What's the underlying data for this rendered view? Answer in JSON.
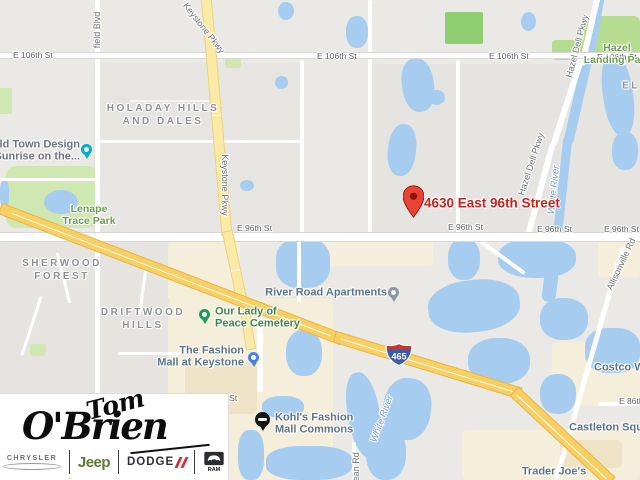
{
  "theme": {
    "land": "#eae9e6",
    "water": "#a6cdf0",
    "park": "#cfe7b0",
    "park_bright": "#8fce71",
    "park_dark": "#b5dc90",
    "cemetery": "#c9e2bd",
    "beige": "#f5eedb",
    "beige_dark": "#eee3c6",
    "road_casing": "#d9d8d4",
    "highway_fill": "#f7cf63",
    "highway_casing": "#e7b54a",
    "parkway_fill": "#fbe9a6",
    "parkway_casing": "#ecd184",
    "street_label": "#63656a",
    "road_label": "#717479",
    "neighborhood_label": "#8f9194",
    "water_label": "#7b9cc4",
    "park_label": "#6f9e50",
    "poi_blue": "#5d7689",
    "poi_green": "#44874a",
    "poi_gray": "#6d7480",
    "dest_red": "#c5251c",
    "pin_red": "#ea4335",
    "pin_red_dark": "#8a1508",
    "pin_teal": "#00b0c7",
    "pin_green": "#1a9e5c",
    "pin_blue": "#4583ec",
    "pin_gray": "#8a99a5",
    "pin_kohls": "#141414",
    "shield_blue": "#3d5ba9",
    "shield_red": "#be3a31"
  },
  "map": {
    "street_labels": [
      {
        "text": "E 106th St"
      },
      {
        "text": "E 106th St"
      },
      {
        "text": "E 106th St"
      },
      {
        "text": "E 106th St"
      },
      {
        "text": "E 96th St"
      },
      {
        "text": "E 96th St"
      },
      {
        "text": "E 96th St"
      },
      {
        "text": "E 96th St"
      },
      {
        "text": "E 86th St"
      },
      {
        "text": "h St"
      }
    ],
    "road_labels": [
      {
        "text": "field Blvd"
      },
      {
        "text": "Keystone Pkwy"
      },
      {
        "text": "Keystone Pkwy"
      },
      {
        "text": "Hazel Dell Pkwy"
      },
      {
        "text": "Hazel Dell Pkwy"
      },
      {
        "text": "Allisonville Rd"
      },
      {
        "text": "Dean Rd"
      }
    ],
    "water_labels": [
      {
        "text": "White River"
      },
      {
        "text": "White River"
      }
    ],
    "park_labels": [
      {
        "l1": "Hazel",
        "l2": "Landing Park"
      },
      {
        "l1": "Lenape",
        "l2": "Trace Park"
      }
    ],
    "neighborhoods": [
      {
        "l1": "HOLADAY HILLS",
        "l2": "AND DALES"
      },
      {
        "l1": "SHERWOOD",
        "l2": "FOREST"
      },
      {
        "l1": "DRIFTWOOD",
        "l2": "HILLS"
      },
      {
        "l1": "EL",
        "l2": ""
      }
    ],
    "pois": [
      {
        "l1": "Old Town Design",
        "l2": "(Sunrise on the..."
      },
      {
        "l1": "Our Lady of",
        "l2": "Peace Cemetery"
      },
      {
        "l1": "The Fashion",
        "l2": "Mall at Keystone"
      },
      {
        "l1": "River Road Apartments",
        "l2": ""
      },
      {
        "l1": "Kohl's Fashion",
        "l2": "Mall Commons"
      },
      {
        "l1": "Trader Joe's",
        "l2": ""
      },
      {
        "l1": "Castleton Square",
        "l2": ""
      },
      {
        "l1": "Costco Wholesale",
        "l2": ""
      }
    ],
    "destination": {
      "address": "4630 East 96th Street"
    },
    "shield": {
      "route": "465"
    }
  },
  "logo": {
    "line1": "Tom",
    "line2": "O'Brien",
    "brands": [
      {
        "label": "CHRYSLER"
      },
      {
        "label": "Jeep"
      },
      {
        "label": "DODGE"
      },
      {
        "label": "RAM"
      }
    ]
  }
}
